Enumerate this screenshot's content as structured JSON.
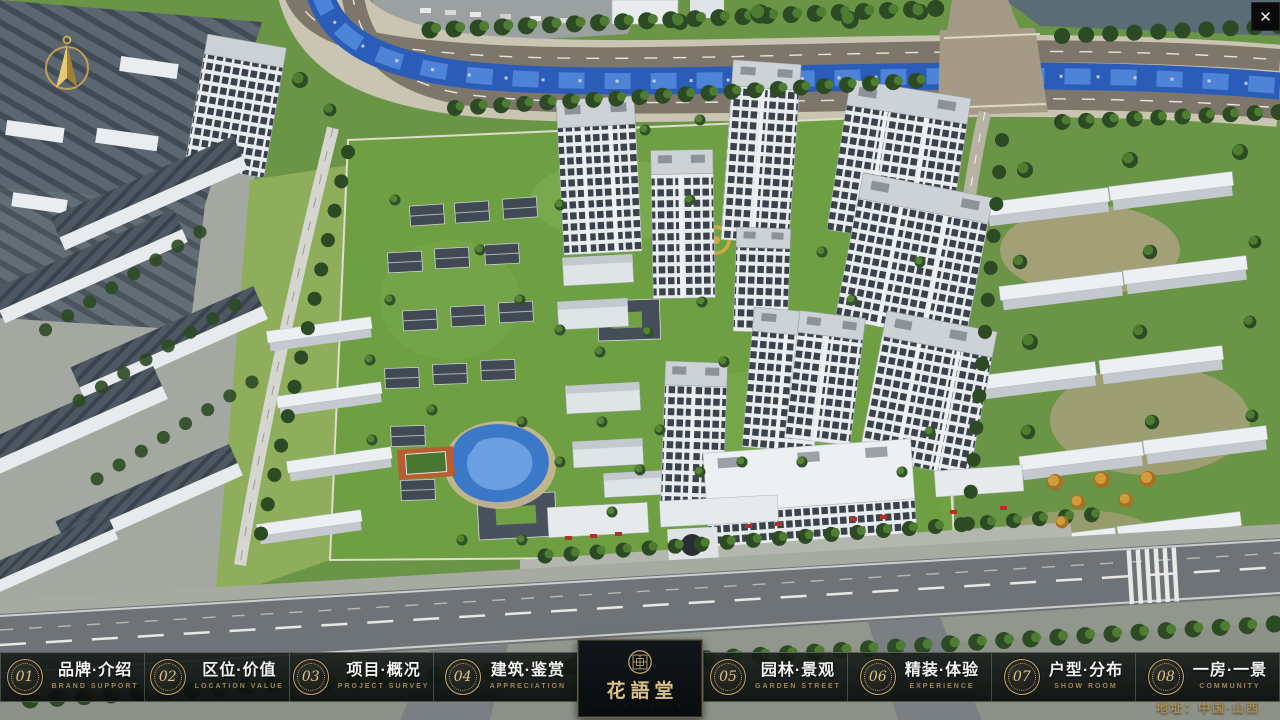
{
  "window": {
    "close_label": "✕"
  },
  "map_overlay": {
    "compass": "north-arrow",
    "address": "地址：中国·山西"
  },
  "logo": {
    "name": "花語堂",
    "subtext": "· · · · · · · · · ·"
  },
  "menu": {
    "items": [
      {
        "num": "01",
        "label": "品牌·介绍",
        "sub": "BRAND SUPPORT"
      },
      {
        "num": "02",
        "label": "区位·价值",
        "sub": "LOCATION VALUE"
      },
      {
        "num": "03",
        "label": "项目·概况",
        "sub": "PROJECT SURVEY"
      },
      {
        "num": "04",
        "label": "建筑·鉴赏",
        "sub": "APPRECIATION"
      },
      {
        "num": "05",
        "label": "园林·景观",
        "sub": "GARDEN STREET"
      },
      {
        "num": "06",
        "label": "精装·体验",
        "sub": "EXPERIENCE"
      },
      {
        "num": "07",
        "label": "户型·分布",
        "sub": "SHOW ROOM"
      },
      {
        "num": "08",
        "label": "一房·一景",
        "sub": "COMMUNITY"
      }
    ]
  },
  "colors": {
    "gold": "#c8ab6e",
    "gold_dim": "#9c8757",
    "bar_background": "#10140f",
    "logo_text": "#d9c088",
    "river_blue": "#2a5cb8",
    "grass_green": "#6b9546",
    "address_text": "#a98f55"
  },
  "scene": {
    "type": "aerial-3d-residential-masterplan"
  }
}
